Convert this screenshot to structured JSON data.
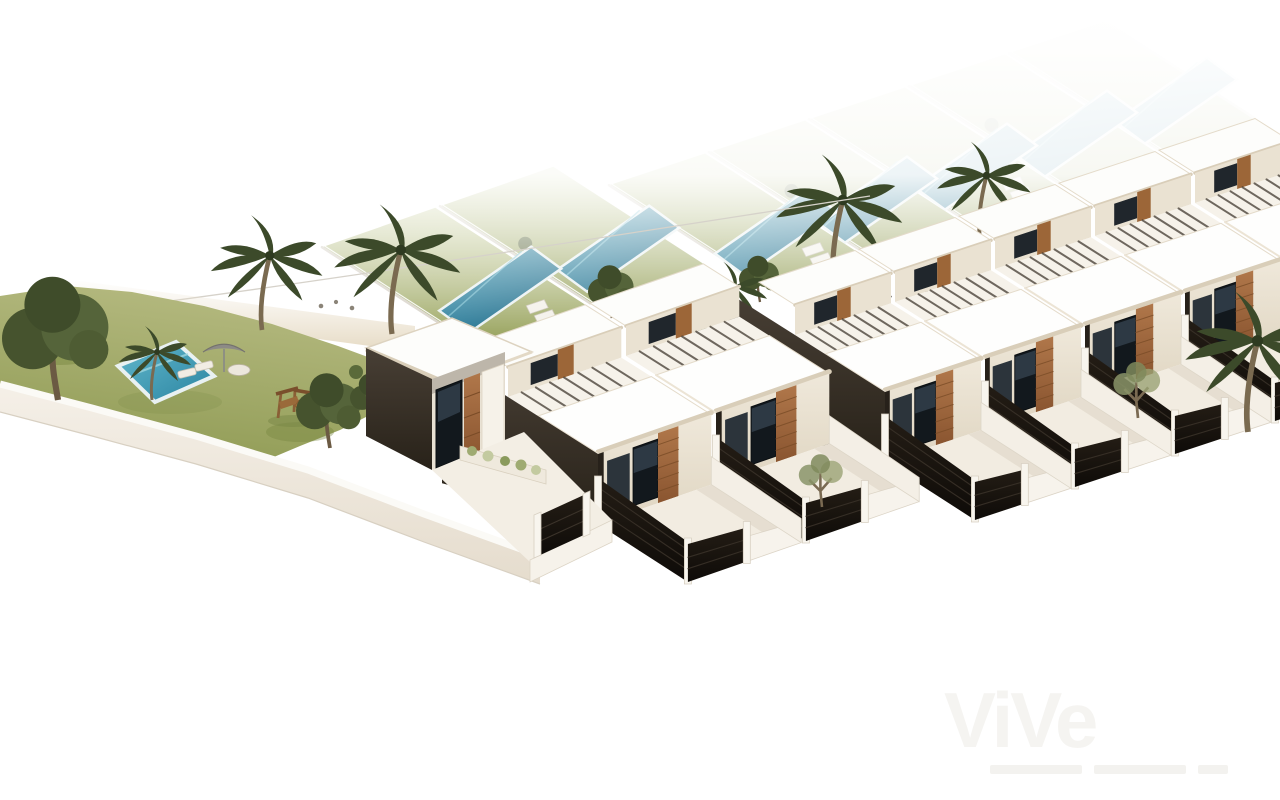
{
  "image": {
    "type": "architectural-3d-render",
    "description": "Aerial 3D rendering of a modern two-storey townhouse development: white flat roofs with beige fascias, dark textured walls, vertical wood-slat panels, full-height glazing, front terraces with shrub planters and black slatted fences, private rear gardens with lap pools and palm trees, and a communal garden with swimming pool, parasol, day bed and children's playground on a white overexposed background.",
    "background_color": "#ffffff"
  },
  "watermark": {
    "logo_text": "ViVe"
  },
  "palette": {
    "background": "#ffffff",
    "roof_white": "#fdfdfb",
    "fascia_beige": "#d9ceb9",
    "facade_cream": "#eae2d3",
    "dark_wall": "#2f2820",
    "wood_accent": "#a06a3c",
    "window_glass": "#12181d",
    "fence_black": "#1a140e",
    "wall_white": "#f2ece2",
    "terrace_floor": "#f2ece1",
    "lawn_green": "#97a25c",
    "communal_pool": "#3f9cb5",
    "garden_pool": "#1d6d88",
    "palm_green": "#3c4a2a",
    "tree_green": "#4e5c33",
    "shrub_olive": "#a8a45a",
    "parasol_gray": "#8d8b86"
  },
  "scene": {
    "development": {
      "townhouse_units": 7,
      "left_block_units": 2,
      "right_block_units": 5,
      "detached_villa": 1
    },
    "rear_gardens": {
      "count": 7,
      "lap_pools": 7,
      "features": [
        "lawn",
        "glass-dividers",
        "palm-trees",
        "sun-loungers"
      ]
    },
    "communal_garden": {
      "swimming_pool": 1,
      "palm_trees": 3,
      "parasol": 1,
      "day_bed": 1,
      "sun_loungers": 2,
      "playground": 1,
      "perimeter_wall": true
    },
    "architecture_features": [
      "white-flat-roofs",
      "beige-fascias",
      "dark-textured-walls",
      "vertical-wood-slat-panels",
      "full-height-glazing",
      "roof-pergola-louvres",
      "front-terraces-with-planters",
      "black-slatted-fences",
      "white-posts"
    ]
  }
}
